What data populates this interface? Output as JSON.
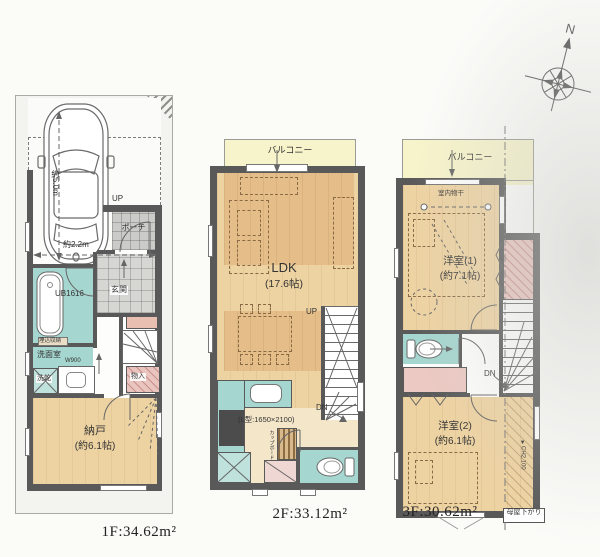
{
  "scene": {
    "bg": "#fbfbf8",
    "wall_color": "#595959",
    "wood_color": "#eed3a2",
    "wood_dark_color": "#e5bd88",
    "bath_color": "#a5d6cf",
    "closet_pink_color": "#eac5bf",
    "balcony_color": "#f7f4cb"
  },
  "compass": {
    "north": "N"
  },
  "floor1": {
    "caption": "1F:34.62m²",
    "up": "UP",
    "porch": "ポーチ",
    "entrance": "玄関",
    "bath": "UB1616",
    "built_in_storage": "埋込収納",
    "washroom": "洗面室",
    "washer_dryer": "洗乾",
    "w900": "W900",
    "closet": "物入",
    "storage_room": "納戸",
    "storage_room_size": "(約6.1帖)",
    "car_length": "約5.0m",
    "car_width": "約2.2m"
  },
  "floor2": {
    "caption": "2F:33.12m²",
    "balcony": "バルコニー",
    "ldk": "LDK",
    "ldk_size": "(17.6帖)",
    "up": "UP",
    "dn": "DN",
    "kitchen_spec": "(L型:1650×2100)",
    "cupboard": "カップボード"
  },
  "floor3": {
    "caption": "3F:30.62m²",
    "balcony": "バルコニー",
    "indoor_drying": "室内物干",
    "room1": "洋室(1)",
    "room1_size": "(約7.1帖)",
    "dn": "DN",
    "room2": "洋室(2)",
    "room2_size": "(約6.1帖)",
    "ceiling_height": "▼CH2,100",
    "sloped_ceiling": "母屋下がり"
  }
}
